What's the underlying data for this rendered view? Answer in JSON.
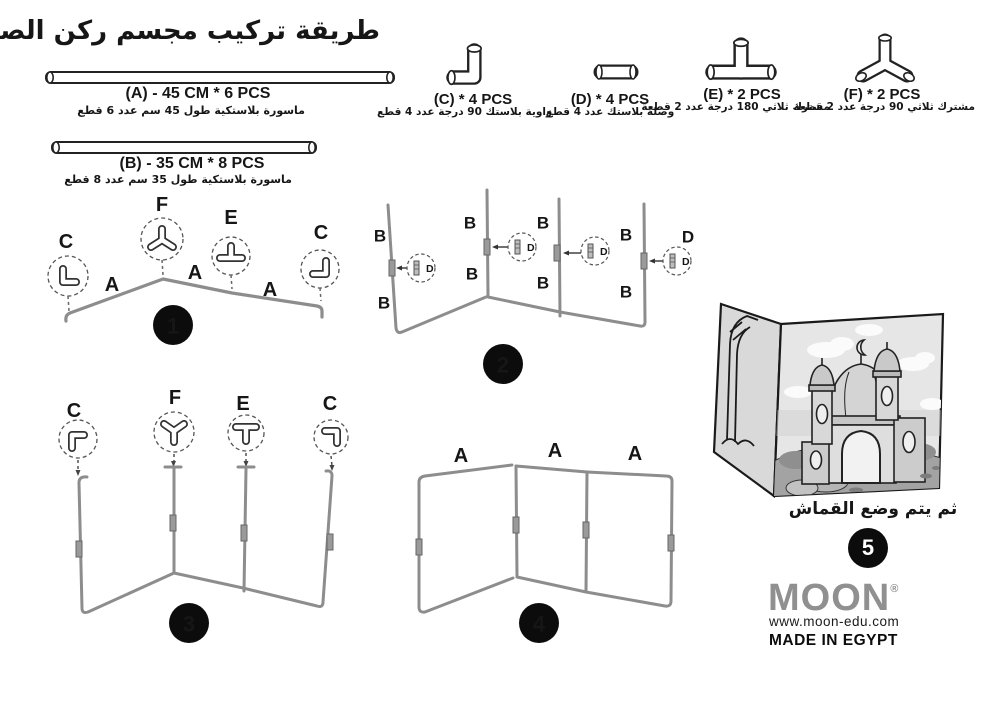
{
  "title": "طريقة تركيب مجسم ركن الصلاة",
  "parts": [
    {
      "id": "A",
      "label": "(A)  - 45 CM * 6 PCS",
      "desc": "ماسورة بلاستكية طول 45 سم عدد 6 قطع"
    },
    {
      "id": "B",
      "label": "(B) - 35 CM * 8 PCS",
      "desc": "ماسورة بلاستكية طول 35 سم عدد 8 قطع"
    },
    {
      "id": "C",
      "label": "(C)  * 4 PCS",
      "desc": "زاوية بلاستك 90 درجة عدد 4 قطع"
    },
    {
      "id": "D",
      "label": "(D)  * 4 PCS",
      "desc": "وصلة بلاستك عدد 4 قطع"
    },
    {
      "id": "E",
      "label": "(E)  * 2 PCS",
      "desc": "مشترك ثلاثي 180 درجة عدد 2 قطعة"
    },
    {
      "id": "F",
      "label": "(F)  * 2 PCS",
      "desc": "مشترك ثلاثي 90 درجة عدد 2 قطعة"
    }
  ],
  "steps": {
    "step1": {
      "number": "1",
      "connectors": [
        "C",
        "F",
        "E",
        "C"
      ],
      "pipes": [
        "A",
        "A",
        "A"
      ]
    },
    "step2": {
      "number": "2",
      "pipe_label": "B",
      "coupling_label": "D"
    },
    "step3": {
      "number": "3",
      "connectors": [
        "C",
        "F",
        "E",
        "C"
      ]
    },
    "step4": {
      "number": "4",
      "pipes": [
        "A",
        "A",
        "A"
      ]
    },
    "step5": {
      "number": "5",
      "caption": "ثم يتم وضع القماش"
    }
  },
  "footer": {
    "brand": "MOON",
    "registered": "®",
    "website": "www.moon-edu.com",
    "origin": "MADE IN EGYPT"
  },
  "colors": {
    "pipe": "#8d8d8d",
    "ink": "#161616",
    "logo_gray": "#909090"
  }
}
